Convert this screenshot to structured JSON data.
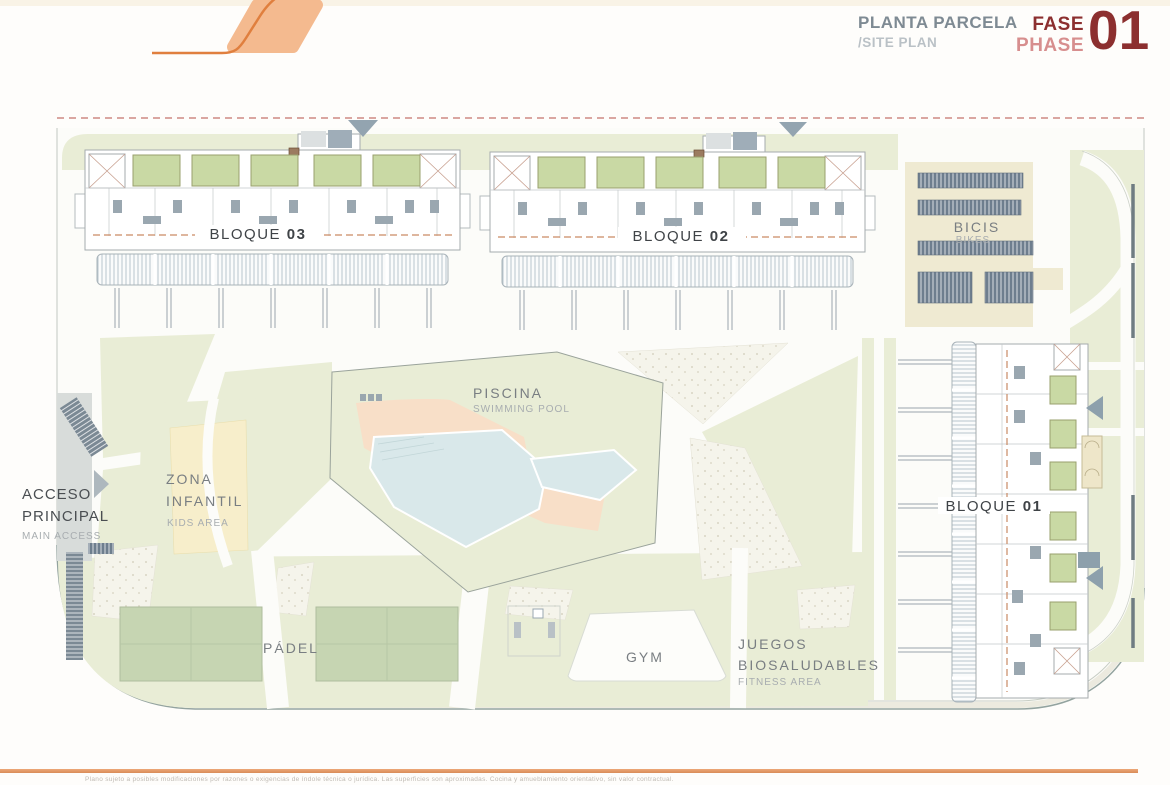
{
  "header": {
    "title_es": "PLANTA PARCELA",
    "title_en": "/SITE PLAN",
    "phase_label_es": "FASE",
    "phase_label_en": "PHASE",
    "phase_number": "01"
  },
  "plan": {
    "blocks": [
      {
        "label": "BLOQUE",
        "number": "03"
      },
      {
        "label": "BLOQUE",
        "number": "02"
      },
      {
        "label": "BLOQUE",
        "number": "01"
      }
    ],
    "areas": {
      "pool": {
        "es": "PISCINA",
        "en": "SWIMMING POOL"
      },
      "bikes": {
        "es": "BICIS",
        "en": "BIKES"
      },
      "kids": {
        "l1": "ZONA",
        "l2": "INFANTIL",
        "en": "KIDS AREA"
      },
      "access": {
        "l1": "ACCESO",
        "l2": "PRINCIPAL",
        "en": "MAIN ACCESS"
      },
      "padel": {
        "es": "PÁDEL"
      },
      "gym": {
        "es": "GYM"
      },
      "fitness": {
        "l1": "JUEGOS",
        "l2": "BIOSALUDABLES",
        "en": "FITNESS AREA"
      }
    }
  },
  "footer": {
    "disclaimer": "Plano sujeto a posibles modificaciones por razones o exigencias de índole técnica o jurídica. Las superficies son aproximadas. Cocina y amueblamiento orientativo, sin valor contractual."
  },
  "colors": {
    "logo_fill": "#f4ba8f",
    "logo_line": "#e07f3e",
    "title_gray": "#7e8a93",
    "subtitle_gray": "#bac1c6",
    "phase_dark": "#8c2f2f",
    "phase_light": "#d78e8e",
    "boundary_dash": "#c4736b",
    "building_dash": "#c98a64",
    "grass": "#e9edd6",
    "court_green": "#c6d5b2",
    "garden_green": "#c9d9a4",
    "pool_water": "#d9e8ea",
    "deck_peach": "#f8dfc8",
    "kids_yellow": "#f7eecb",
    "bike_cream": "#efead2",
    "rack_slate": "#6e7e8e",
    "road_gray": "#d8dcda",
    "footer_rule": "#d98b58"
  }
}
